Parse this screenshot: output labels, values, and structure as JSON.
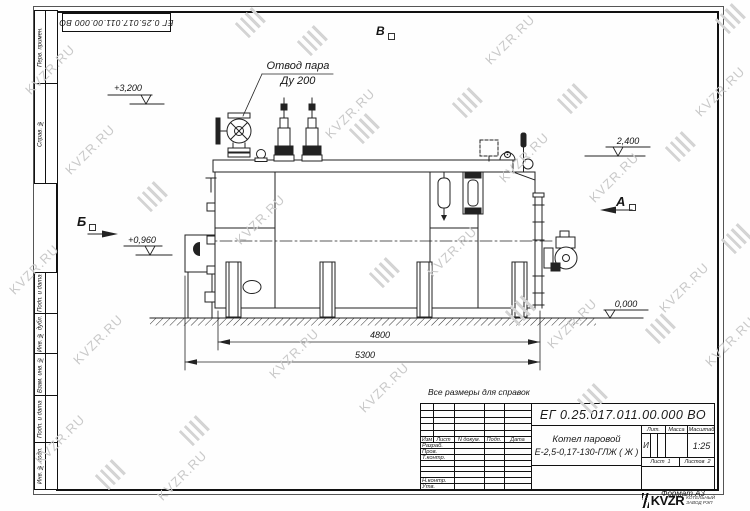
{
  "stamp": {
    "doc_number": "ЕГ 0.25.017.011.00.000  ВО"
  },
  "note": "Все размеры для справок",
  "format_label": "Формат А3",
  "title_block": {
    "doc_number": "ЕГ 0.25.017.011.00.000  ВО",
    "product_name_line1": "Котел паровой",
    "product_name_line2": "Е-2,5-0,17-130-ГЛЖ ( Ж )",
    "header_cols": [
      "Изм",
      "Лист",
      "N докум.",
      "Подп.",
      "Дата"
    ],
    "sign_rows": [
      "Разраб.",
      "Пров.",
      "Т.контр.",
      "Н.контр.",
      "Утв."
    ],
    "lit_label": "Лит.",
    "mass_label": "Масса",
    "scale_label": "Масштаб",
    "lit_value": "И",
    "scale_value": "1:25",
    "sheet_label": "Лист",
    "sheet_value": "1",
    "sheets_label": "Листов",
    "sheets_value": "2",
    "company_logo_text": "KVZR",
    "company_name_line1": "КОТЕЛЬНЫЙ",
    "company_name_line2": "ЗАВОД РЭП"
  },
  "margin_columns": {
    "top": [
      "Перв. примен.",
      "Справ. №"
    ],
    "bottom": [
      "Подп. и дата",
      "Инв. № дубл.",
      "Взам. инв. №",
      "Подп. и дата",
      "Инв. № подл."
    ]
  },
  "drawing": {
    "callout_line1": "Отвод пара",
    "callout_line2": "Ду 200",
    "elevation_top": "+3,200",
    "elevation_drum": "2,400",
    "elevation_burner": "+0,960",
    "elevation_ground": "0,000",
    "view_b_top": "В",
    "view_b_side": "Б",
    "view_a_side": "А",
    "dim_inner": "4800",
    "dim_outer": "5300"
  },
  "watermark": {
    "text": "KVZR.RU"
  }
}
